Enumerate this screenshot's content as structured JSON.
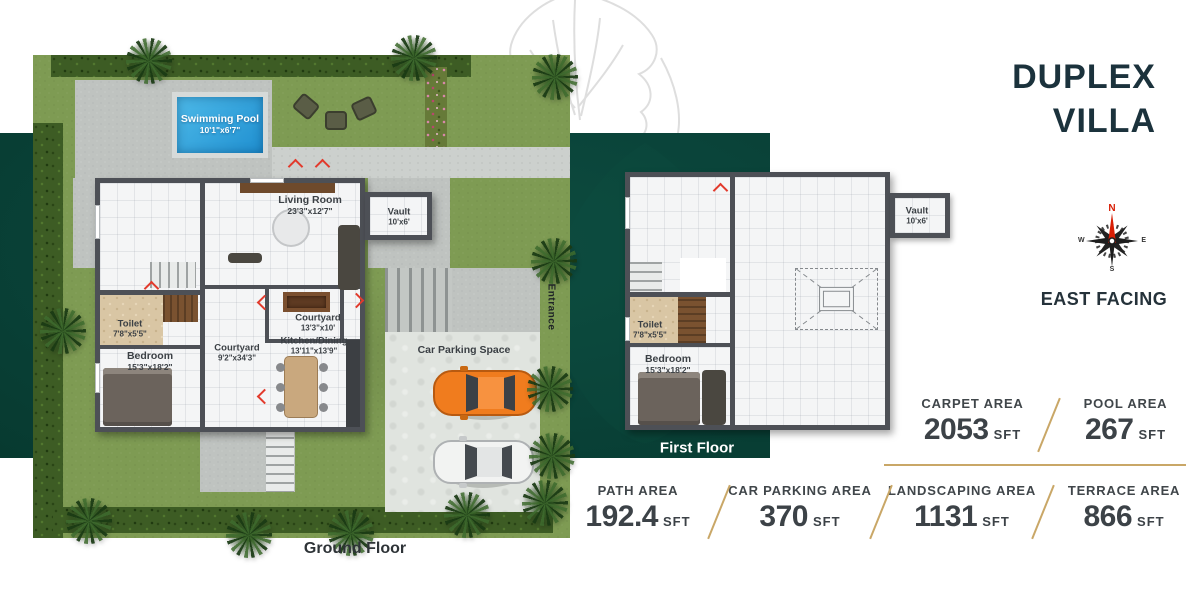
{
  "header": {
    "title_line1": "DUPLEX",
    "title_line2": "VILLA",
    "facing": "EAST FACING",
    "compass": {
      "n": "N",
      "e": "E",
      "s": "S",
      "w": "W"
    }
  },
  "ground_floor": {
    "caption": "Ground Floor",
    "rooms": {
      "pool": {
        "name": "Swimming Pool",
        "size": "10'1\"x6'7\""
      },
      "living": {
        "name": "Living Room",
        "size": "23'3\"x12'7\""
      },
      "vault": {
        "name": "Vault",
        "size": "10'x6'"
      },
      "toilet": {
        "name": "Toilet",
        "size": "7'8\"x5'5\""
      },
      "bedroom": {
        "name": "Bedroom",
        "size": "15'3\"x18'2\""
      },
      "courtyard_main": {
        "name": "Courtyard",
        "size": "9'2\"x34'3\""
      },
      "courtyard_small": {
        "name": "Courtyard",
        "size": "13'3\"x10'"
      },
      "kitchen": {
        "name": "Kitchen/Dining",
        "size": "13'11\"x13'9\""
      },
      "parking": {
        "name": "Car Parking Space"
      },
      "entrance": {
        "name": "Entrance"
      }
    }
  },
  "first_floor": {
    "caption": "First Floor",
    "rooms": {
      "toilet": {
        "name": "Toilet",
        "size": "7'8\"x5'5\""
      },
      "bedroom": {
        "name": "Bedroom",
        "size": "15'3\"x18'2\""
      },
      "vault": {
        "name": "Vault",
        "size": "10'x6'"
      }
    }
  },
  "stats": {
    "primary": [
      {
        "label": "CARPET AREA",
        "value": "2053",
        "unit": "SFT"
      },
      {
        "label": "POOL AREA",
        "value": "267",
        "unit": "SFT"
      }
    ],
    "secondary": [
      {
        "label": "PATH AREA",
        "value": "192.4",
        "unit": "SFT"
      },
      {
        "label": "CAR PARKING AREA",
        "value": "370",
        "unit": "SFT"
      },
      {
        "label": "LANDSCAPING AREA",
        "value": "1131",
        "unit": "SFT"
      },
      {
        "label": "TERRACE AREA",
        "value": "866",
        "unit": "SFT"
      }
    ]
  },
  "colors": {
    "brand_teal": "#0A4136",
    "accent_gold": "#C9A767",
    "title_ink": "#1B323C",
    "stat_ink": "#3C4247"
  }
}
